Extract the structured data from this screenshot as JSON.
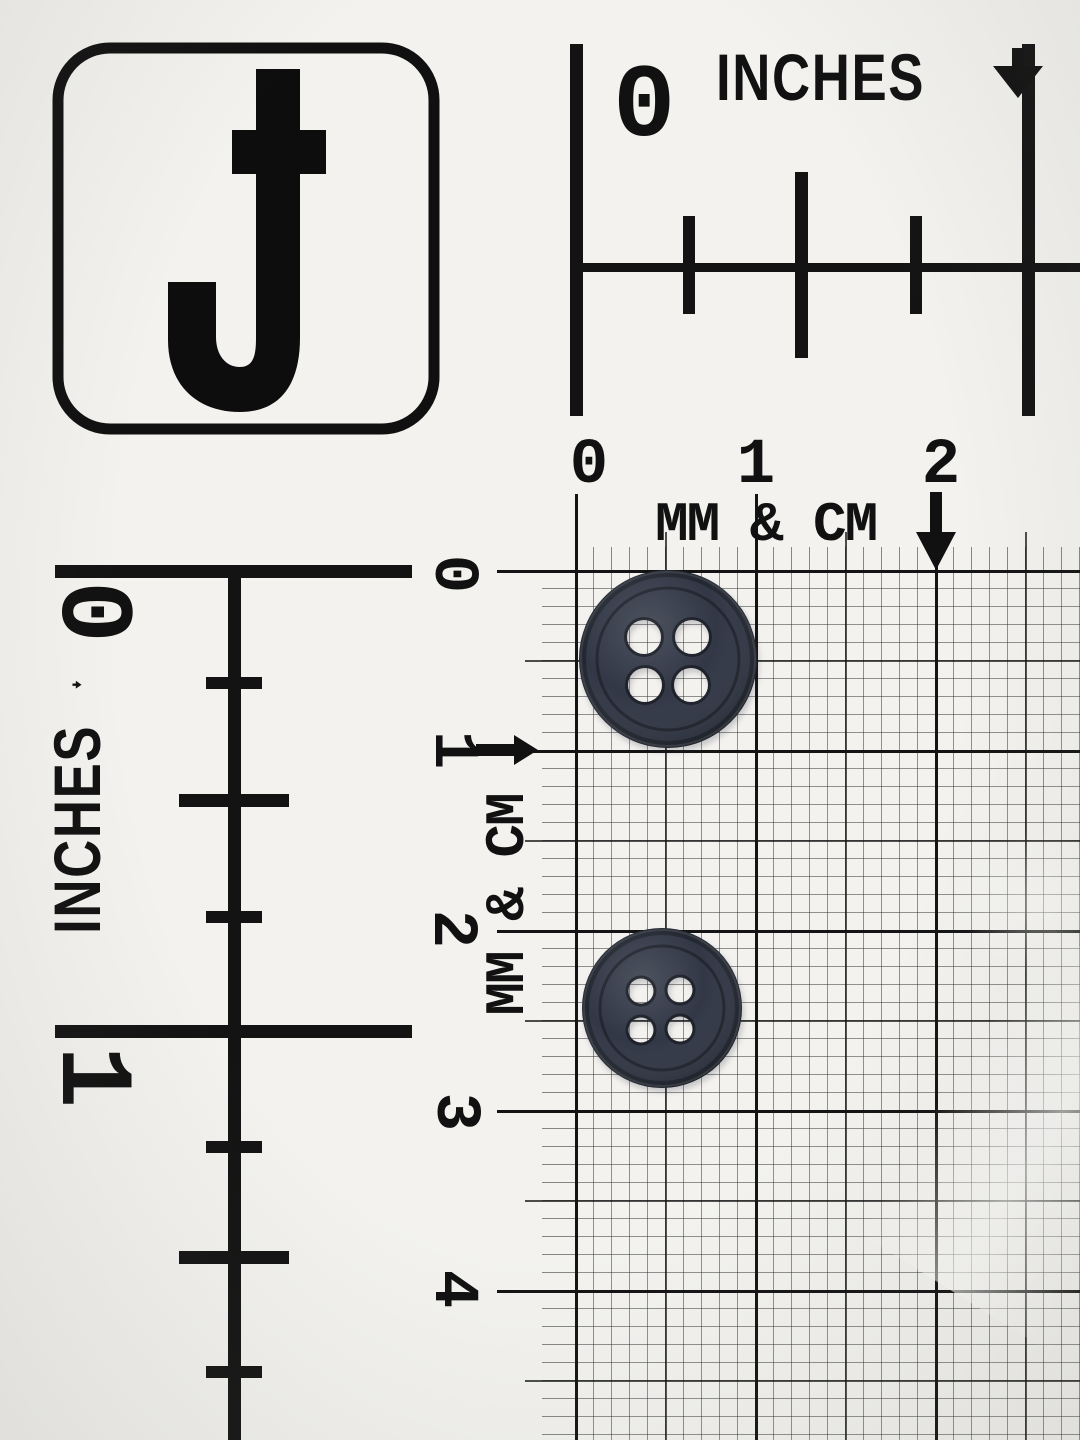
{
  "scene": {
    "description": "Two dark navy four-hole sewing buttons photographed on a white measuring scale card with inch rulers and a millimeter/centimeter grid",
    "paper_color": "#f3f2ef",
    "ink_color": "#131313",
    "grid": {
      "cm_spacing_px": 180,
      "mm_per_cell": 1
    }
  },
  "logo": {
    "letter": "J"
  },
  "inch_ruler_top": {
    "title": "INCHES",
    "arrow_icon": "down-arrow",
    "labels": [
      "0"
    ]
  },
  "inch_ruler_left": {
    "title": "INCHES",
    "arrow_icon": "down-arrow",
    "labels": [
      "0",
      "1"
    ]
  },
  "metric_scale_top": {
    "title": "MM & CM",
    "arrow_icon": "down-arrow",
    "labels": [
      "0",
      "1",
      "2"
    ]
  },
  "metric_scale_left": {
    "title": "MM & CM",
    "arrow_icon": "right-arrow",
    "labels": [
      "0",
      "1",
      "2",
      "3",
      "4"
    ]
  },
  "buttons": {
    "hole_count": 4,
    "face_color": "#2b3140",
    "rim_color": "#1b202a",
    "count": 2
  }
}
